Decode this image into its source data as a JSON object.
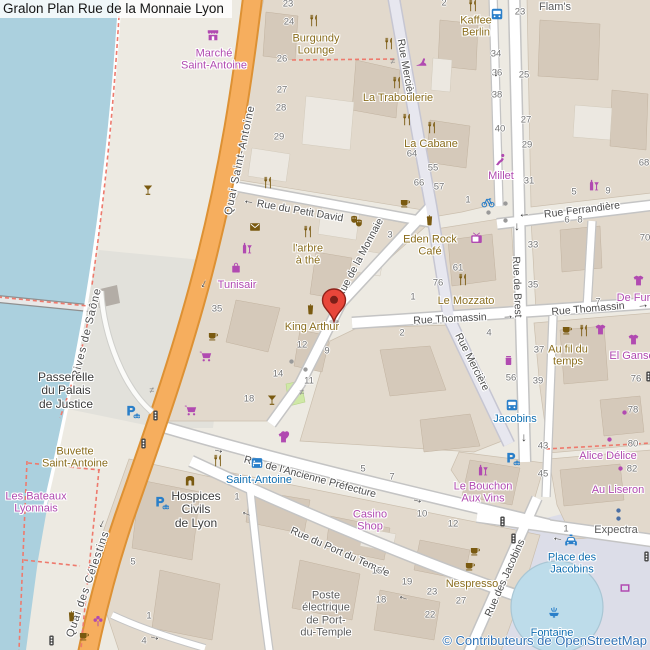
{
  "title": "Gralon Plan Rue de la Monnaie Lyon",
  "attribution": "© Contributeurs de OpenStreetMap",
  "palette": {
    "water": "#abd0de",
    "road_primary": "#f6ae5e",
    "pedestrian_area": "#dcdde8",
    "building": "#d5c9ba",
    "poi_brown": "#8a6d1d",
    "poi_magenta": "#b04ab0",
    "poi_blue": "#0f6eb0",
    "footpath_red": "#ee7a6d",
    "pin_red": "#e8463a",
    "park_green": "#cfe8a6",
    "fountain_water": "#bddcea"
  },
  "marker": {
    "x": 334,
    "y": 322
  },
  "streets": [
    [
      "Quai Saint-Antoine",
      240,
      160,
      -78,
      "road sp"
    ],
    [
      "Quai des Célestins",
      88,
      584,
      -71,
      "road sp"
    ],
    [
      "Rives de Saône",
      87,
      333,
      -76,
      "path sp"
    ],
    [
      "Rue du Petit David",
      300,
      211,
      10,
      "road"
    ],
    [
      "Rue Mercière",
      406,
      70,
      80,
      "road"
    ],
    [
      "Rue Mercière",
      472,
      362,
      63,
      "road"
    ],
    [
      "Rue Ferrandière",
      582,
      210,
      -7,
      "road"
    ],
    [
      "Rue de Brest",
      517,
      287,
      88,
      "road"
    ],
    [
      "Rue Thomassin",
      450,
      319,
      -3,
      "road"
    ],
    [
      "Rue Thomassin",
      588,
      309,
      -5,
      "road"
    ],
    [
      "Rue de la Monnaie",
      360,
      258,
      -62,
      "road"
    ],
    [
      "Rue de l'Ancienne Préfecture",
      310,
      477,
      15,
      "road"
    ],
    [
      "Rue du Port du Temple",
      340,
      552,
      24,
      "road"
    ],
    [
      "Rue des Jacobins",
      505,
      578,
      -66,
      "road"
    ]
  ],
  "places": [
    [
      "marche-saint-antoine",
      [
        "Marché",
        "Saint-Antoine"
      ],
      214,
      60,
      "magenta"
    ],
    [
      "burgundy-lounge",
      [
        "Burgundy",
        "Lounge"
      ],
      316,
      45,
      "brown"
    ],
    [
      "la-traboulerie",
      [
        "La Traboulerie"
      ],
      398,
      98,
      "brown"
    ],
    [
      "la-cabane",
      [
        "La Cabane"
      ],
      431,
      144,
      "brown"
    ],
    [
      "kaffee-berlin",
      [
        "Kaffee",
        "Berlin"
      ],
      476,
      27,
      "brown"
    ],
    [
      "flams",
      [
        "Flam's"
      ],
      555,
      7,
      "gray"
    ],
    [
      "millet",
      [
        "Millet"
      ],
      501,
      176,
      "magenta"
    ],
    [
      "larbre-a-the",
      [
        "l'arbre",
        "à thé"
      ],
      308,
      255,
      "brown"
    ],
    [
      "eden-rock-cafe",
      [
        "Eden Rock",
        "Café"
      ],
      430,
      246,
      "brown"
    ],
    [
      "le-mozzato",
      [
        "Le Mozzato"
      ],
      466,
      301,
      "brown"
    ],
    [
      "king-arthur",
      [
        "King Arthur"
      ],
      312,
      327,
      "brown"
    ],
    [
      "tunisair",
      [
        "Tunisair"
      ],
      237,
      285,
      "magenta"
    ],
    [
      "au-fil-du-temps",
      [
        "Au fil du",
        "temps"
      ],
      568,
      356,
      "brown"
    ],
    [
      "el-ganso",
      [
        "El Ganso"
      ],
      632,
      356,
      "magenta"
    ],
    [
      "de-fursac",
      [
        "De Fursac"
      ],
      642,
      298,
      "magenta"
    ],
    [
      "alice-delice",
      [
        "Alice Délice"
      ],
      608,
      456,
      "magenta"
    ],
    [
      "au-liseron",
      [
        "Au Liseron"
      ],
      618,
      490,
      "magenta"
    ],
    [
      "expectra",
      [
        "Expectra"
      ],
      616,
      530,
      "gray"
    ],
    [
      "passerelle-du-palais-de-justice",
      [
        "Passerelle",
        "du Palais",
        "de Justice"
      ],
      66,
      391,
      "dark"
    ],
    [
      "buvette-saint-antoine",
      [
        "Buvette",
        "Saint-Antoine"
      ],
      75,
      458,
      "brown"
    ],
    [
      "les-bateaux-lyonnais",
      [
        "Les Bateaux",
        "Lyonnais"
      ],
      36,
      503,
      "magenta"
    ],
    [
      "hospices-civils-de-lyon",
      [
        "Hospices",
        "Civils",
        "de Lyon"
      ],
      196,
      510,
      "dark"
    ],
    [
      "saint-antoine-hotel",
      [
        "Saint-Antoine"
      ],
      259,
      480,
      "blue"
    ],
    [
      "casino-shop",
      [
        "Casino",
        "Shop"
      ],
      370,
      521,
      "magenta"
    ],
    [
      "le-bouchon-aux-vins",
      [
        "Le Bouchon",
        "Aux Vins"
      ],
      483,
      493,
      "magenta"
    ],
    [
      "nespresso",
      [
        "Nespresso"
      ],
      472,
      584,
      "brown"
    ],
    [
      "poste-electrique",
      [
        "Poste",
        "électrique",
        "de Port-",
        "du-Temple"
      ],
      326,
      614,
      "gray"
    ],
    [
      "jacobins-stop",
      [
        "Jacobins"
      ],
      515,
      419,
      "blue"
    ],
    [
      "place-des-jacobins",
      [
        "Place des",
        "Jacobins"
      ],
      572,
      564,
      "blue"
    ],
    [
      "fontaine",
      [
        "Fontaine"
      ],
      552,
      633,
      "blue"
    ]
  ],
  "house_numbers": [
    [
      288,
      4,
      "23"
    ],
    [
      289,
      22,
      "24"
    ],
    [
      282,
      59,
      "26"
    ],
    [
      282,
      90,
      "27"
    ],
    [
      281,
      108,
      "28"
    ],
    [
      279,
      137,
      "29"
    ],
    [
      444,
      3,
      "2"
    ],
    [
      520,
      12,
      "23"
    ],
    [
      496,
      54,
      "34"
    ],
    [
      497,
      73,
      "36"
    ],
    [
      524,
      75,
      "25"
    ],
    [
      497,
      95,
      "38"
    ],
    [
      500,
      129,
      "40"
    ],
    [
      526,
      120,
      "27"
    ],
    [
      527,
      145,
      "29"
    ],
    [
      412,
      154,
      "64"
    ],
    [
      433,
      168,
      "55"
    ],
    [
      419,
      183,
      "66"
    ],
    [
      439,
      187,
      "57"
    ],
    [
      468,
      200,
      "1"
    ],
    [
      529,
      181,
      "31"
    ],
    [
      574,
      192,
      "5"
    ],
    [
      608,
      191,
      "9"
    ],
    [
      567,
      220,
      "6"
    ],
    [
      580,
      220,
      "8"
    ],
    [
      533,
      245,
      "33"
    ],
    [
      533,
      285,
      "35"
    ],
    [
      644,
      163,
      "68"
    ],
    [
      645,
      238,
      "70"
    ],
    [
      598,
      302,
      "7"
    ],
    [
      390,
      235,
      "3"
    ],
    [
      217,
      309,
      "35"
    ],
    [
      438,
      283,
      "76"
    ],
    [
      458,
      268,
      "61"
    ],
    [
      413,
      297,
      "1"
    ],
    [
      402,
      333,
      "2"
    ],
    [
      302,
      345,
      "12"
    ],
    [
      327,
      351,
      "9"
    ],
    [
      278,
      374,
      "14"
    ],
    [
      309,
      381,
      "11"
    ],
    [
      489,
      333,
      "4"
    ],
    [
      511,
      378,
      "56"
    ],
    [
      539,
      350,
      "37"
    ],
    [
      538,
      381,
      "39"
    ],
    [
      543,
      446,
      "43"
    ],
    [
      543,
      474,
      "45"
    ],
    [
      636,
      379,
      "76"
    ],
    [
      633,
      410,
      "78"
    ],
    [
      633,
      444,
      "80"
    ],
    [
      632,
      469,
      "82"
    ],
    [
      363,
      469,
      "5"
    ],
    [
      392,
      477,
      "7"
    ],
    [
      237,
      497,
      "1"
    ],
    [
      422,
      514,
      "10"
    ],
    [
      453,
      524,
      "12"
    ],
    [
      249,
      399,
      "18"
    ],
    [
      377,
      571,
      "15"
    ],
    [
      407,
      582,
      "19"
    ],
    [
      381,
      600,
      "18"
    ],
    [
      432,
      592,
      "23"
    ],
    [
      430,
      615,
      "22"
    ],
    [
      461,
      601,
      "27"
    ],
    [
      133,
      562,
      "5"
    ],
    [
      149,
      616,
      "1"
    ],
    [
      144,
      641,
      "4"
    ],
    [
      566,
      529,
      "1"
    ]
  ],
  "icons": [
    [
      "market",
      213,
      35,
      "magenta"
    ],
    [
      "restaurant",
      313,
      20,
      "brown"
    ],
    [
      "restaurant",
      388,
      43,
      "brown"
    ],
    [
      "restaurant",
      396,
      82,
      "brown"
    ],
    [
      "restaurant",
      406,
      119,
      "brown"
    ],
    [
      "restaurant",
      431,
      127,
      "brown"
    ],
    [
      "restaurant",
      472,
      5,
      "brown"
    ],
    [
      "restaurant",
      267,
      182,
      "brown"
    ],
    [
      "restaurant",
      307,
      231,
      "brown"
    ],
    [
      "restaurant",
      462,
      279,
      "brown"
    ],
    [
      "restaurant",
      217,
      460,
      "brown"
    ],
    [
      "restaurant",
      583,
      330,
      "brown"
    ],
    [
      "cafe",
      405,
      203,
      "brown"
    ],
    [
      "cafe",
      567,
      330,
      "brown"
    ],
    [
      "cafe",
      475,
      551,
      "brown"
    ],
    [
      "cafe",
      470,
      566,
      "brown"
    ],
    [
      "cafe",
      84,
      636,
      "brown"
    ],
    [
      "cafe",
      213,
      336,
      "brown"
    ],
    [
      "drink",
      429,
      220,
      "brown"
    ],
    [
      "drink",
      310,
      309,
      "brown"
    ],
    [
      "drink",
      71,
      616,
      "brown"
    ],
    [
      "cocktail",
      272,
      400,
      "brown"
    ],
    [
      "cocktail",
      148,
      190,
      "brown"
    ],
    [
      "envelope",
      255,
      227,
      "brown"
    ],
    [
      "masks",
      356,
      221,
      "brown"
    ],
    [
      "arch",
      190,
      481,
      "brown"
    ],
    [
      "wine",
      246,
      248,
      "magenta"
    ],
    [
      "wine",
      593,
      185,
      "magenta"
    ],
    [
      "wine",
      482,
      470,
      "magenta"
    ],
    [
      "bag",
      236,
      268,
      "magenta"
    ],
    [
      "tshirt",
      638,
      280,
      "magenta"
    ],
    [
      "tshirt",
      600,
      329,
      "magenta"
    ],
    [
      "tshirt",
      633,
      339,
      "magenta"
    ],
    [
      "tshirt",
      283,
      437,
      "magenta"
    ],
    [
      "cart",
      205,
      356,
      "magenta"
    ],
    [
      "cart",
      190,
      410,
      "magenta"
    ],
    [
      "flower",
      98,
      621,
      "magenta"
    ],
    [
      "heart",
      285,
      435,
      "magenta"
    ],
    [
      "jar",
      508,
      360,
      "magenta"
    ],
    [
      "tv",
      476,
      238,
      "magenta"
    ],
    [
      "shoe",
      421,
      62,
      "magenta"
    ],
    [
      "climber",
      500,
      159,
      "magenta"
    ],
    [
      "frame",
      625,
      588,
      "magenta"
    ],
    [
      "bus",
      497,
      14,
      "blue"
    ],
    [
      "bus",
      512,
      405,
      "blue"
    ],
    [
      "bed",
      257,
      463,
      "blue"
    ],
    [
      "bike",
      488,
      202,
      "blue"
    ],
    [
      "parking",
      133,
      412,
      "blue"
    ],
    [
      "parking",
      162,
      503,
      "blue"
    ],
    [
      "parking",
      513,
      459,
      "blue"
    ],
    [
      "taxi",
      571,
      541,
      "blue"
    ],
    [
      "fountain",
      554,
      612,
      "blue"
    ],
    [
      "traffic",
      155,
      415,
      "dark"
    ],
    [
      "traffic",
      143,
      443,
      "dark"
    ],
    [
      "traffic",
      51,
      640,
      "dark"
    ],
    [
      "traffic",
      502,
      521,
      "dark"
    ],
    [
      "traffic",
      513,
      538,
      "dark"
    ],
    [
      "traffic",
      646,
      556,
      "dark"
    ],
    [
      "traffic",
      648,
      376,
      "dark"
    ],
    [
      "dot",
      505,
      203,
      "graydot"
    ],
    [
      "dot",
      505,
      220,
      "graydot"
    ],
    [
      "dot",
      488,
      212,
      "graydot"
    ],
    [
      "dot",
      291,
      361,
      "graydot"
    ],
    [
      "dot",
      305,
      369,
      "graydot"
    ],
    [
      "dot",
      624,
      412,
      "magentadot"
    ],
    [
      "dot",
      609,
      439,
      "magentadot"
    ],
    [
      "dot",
      620,
      468,
      "magentadot"
    ],
    [
      "dot",
      618,
      510,
      "bluedot"
    ],
    [
      "dot",
      618,
      518,
      "bluedot"
    ]
  ],
  "arrows": [
    [
      "←",
      249,
      200,
      8
    ],
    [
      "←",
      524,
      213,
      -6
    ],
    [
      "→",
      508,
      315,
      -3
    ],
    [
      "→",
      643,
      304,
      -5
    ],
    [
      "→",
      219,
      449,
      13
    ],
    [
      "→",
      418,
      499,
      15
    ],
    [
      "←",
      247,
      512,
      22
    ],
    [
      "←",
      404,
      596,
      18
    ],
    [
      "↓",
      496,
      72,
      0
    ],
    [
      "↓",
      517,
      226,
      0
    ],
    [
      "↓",
      524,
      437,
      0
    ],
    [
      "←",
      558,
      537,
      8
    ],
    [
      "←",
      202,
      283,
      -65
    ],
    [
      "←",
      100,
      523,
      -65
    ],
    [
      "→",
      155,
      636,
      14
    ]
  ],
  "barriers": [
    [
      393,
      61
    ],
    [
      302,
      392
    ],
    [
      152,
      390
    ]
  ]
}
